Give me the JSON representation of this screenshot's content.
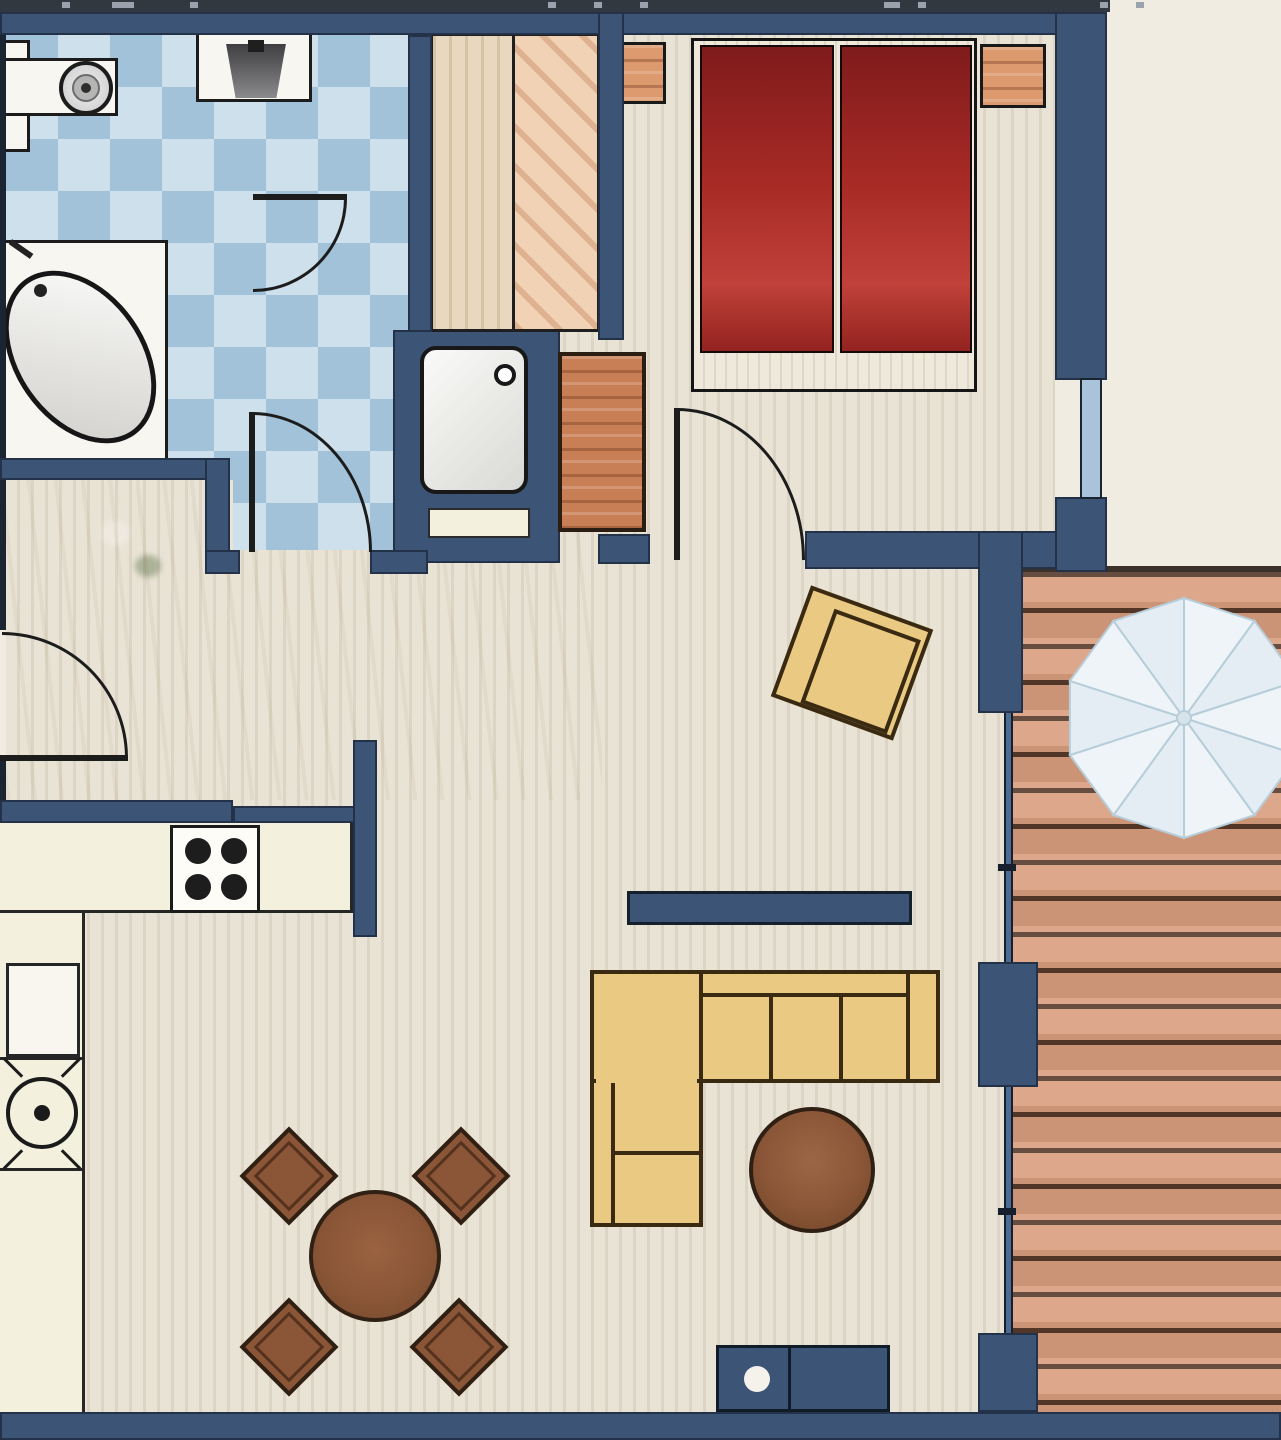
{
  "meta": {
    "title": "Apartment floor plan (top-down architectural drawing, no text labels)"
  },
  "palette": {
    "wall": "#3c5476",
    "wall_edge": "#1b2531",
    "charcoal": "#31383f",
    "tick": "#9aa3ad",
    "beige": "#f0ece1",
    "floor_a": "#e9e3d5",
    "floor_b": "#dcd5c5",
    "tile_light": "#cde0ec",
    "tile_dark": "#a2c2d9",
    "fixture_white": "#f8f6f0",
    "ink": "#1c1c1c",
    "bed_red_dark": "#7f1b1b",
    "bed_red": "#c0413a",
    "nightstand": "#dd9a6f",
    "wardrobe_left": "#e7d8bf",
    "wardrobe_right": "#f2d2b4",
    "dresser": "#c87f55",
    "sofa": "#eac982",
    "sofa_line": "#3a2a12",
    "table_brown": "#8a5637",
    "table_brown_dark": "#6f4226",
    "counter": "#f3f0dd",
    "deck_plank": "#d89d7e",
    "deck_gap": "#56392a",
    "glass": "#a9c4da",
    "glass_door": "#4d6c94",
    "parasol": "#eef4f8",
    "parasol_alt": "#e3edf3",
    "parasol_line": "#b7cdd9",
    "plant": "#79b168"
  },
  "rooms": [
    {
      "id": "bathroom",
      "label": "tiled bathroom (checkerboard blue tiles)"
    },
    {
      "id": "bedroom",
      "label": "bedroom with double bed"
    },
    {
      "id": "hallway",
      "label": "hallway with wardrobe and plant"
    },
    {
      "id": "kitchen",
      "label": "open kitchen corner"
    },
    {
      "id": "living-room",
      "label": "living / dining room"
    },
    {
      "id": "terrace",
      "label": "wood deck terrace with parasol"
    }
  ],
  "fixtures": [
    "washbasin",
    "toilet",
    "corner-bathtub",
    "shower",
    "shower-shelf",
    "wardrobe-two-door",
    "hall-dresser",
    "double-bed",
    "duvet-left",
    "duvet-right",
    "nightstand-left",
    "nightstand-right",
    "bedroom-window",
    "entrance-door",
    "bathroom-door-upper",
    "bathroom-door-lower",
    "bedroom-door",
    "kitchen-counter",
    "hob-4-burners",
    "dishwasher",
    "round-sink",
    "tv-board",
    "armchair",
    "corner-sofa",
    "coffee-table",
    "dining-table",
    "dining-chair-1",
    "dining-chair-2",
    "dining-chair-3",
    "dining-chair-4",
    "fireplace-unit",
    "plant",
    "terrace-deck",
    "glass-sliding-doors",
    "parasol"
  ],
  "ticks": [
    {
      "x": 62,
      "w": 8
    },
    {
      "x": 112,
      "w": 22
    },
    {
      "x": 190,
      "w": 8
    },
    {
      "x": 548,
      "w": 8
    },
    {
      "x": 594,
      "w": 8
    },
    {
      "x": 640,
      "w": 8
    },
    {
      "x": 884,
      "w": 16
    },
    {
      "x": 918,
      "w": 8
    },
    {
      "x": 1100,
      "w": 8
    },
    {
      "x": 1136,
      "w": 8
    }
  ]
}
